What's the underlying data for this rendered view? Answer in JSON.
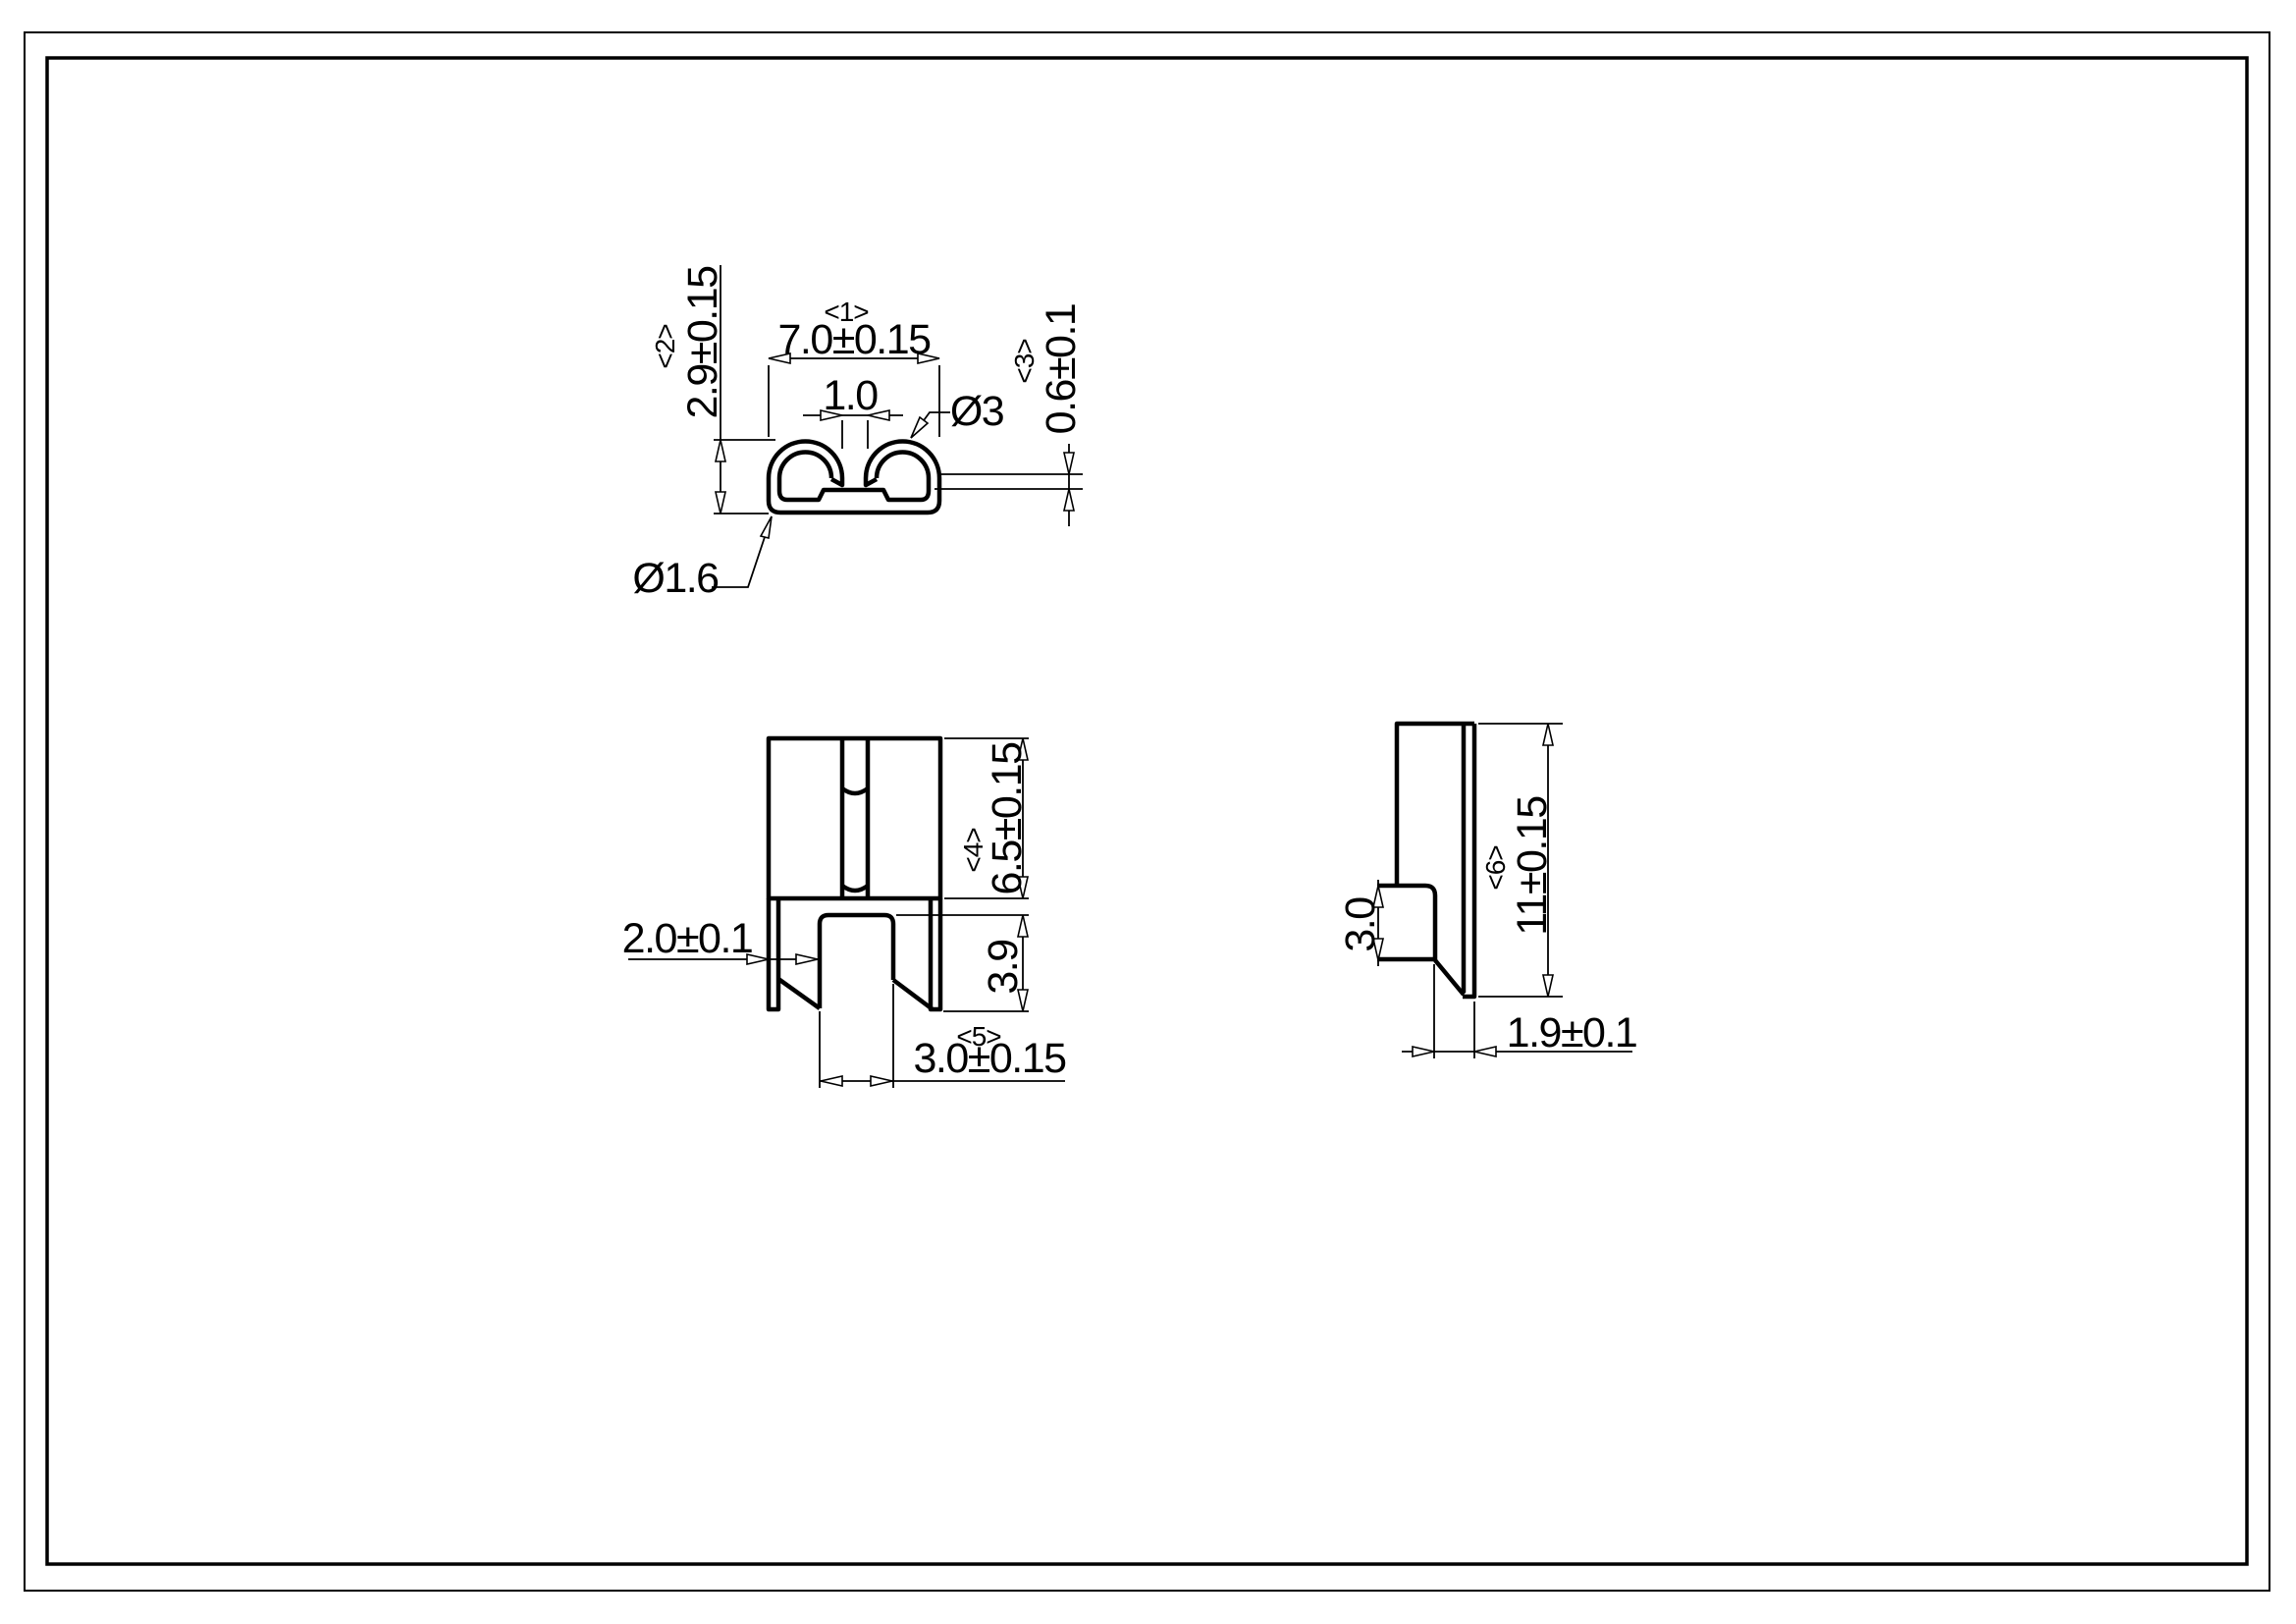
{
  "drawing": {
    "type": "engineering-drawing",
    "colors": {
      "line": "#000000",
      "background": "#ffffff"
    },
    "views": {
      "top": {
        "dim_width": {
          "tag": "<1>",
          "value": "7.0±0.15"
        },
        "dim_height": {
          "tag": "<2>",
          "value": "2.9±0.15"
        },
        "dim_thickness": {
          "tag": "<3>",
          "value": "0.6±0.1"
        },
        "dim_gap": {
          "value": "1.0"
        },
        "dim_hook_diameter": {
          "value": "Ø3"
        },
        "dim_corner_diameter": {
          "value": "Ø1.6"
        }
      },
      "front": {
        "dim_body_height": {
          "tag": "<4>",
          "value": "6.5±0.15"
        },
        "dim_leg_height": {
          "value": "3.9"
        },
        "dim_leg_offset": {
          "value": "2.0±0.1"
        },
        "dim_tab_width": {
          "tag": "<5>",
          "value": "3.0±0.15"
        }
      },
      "side": {
        "dim_height": {
          "tag": "<6>",
          "value": "11±0.15"
        },
        "dim_tab_height": {
          "value": "3.0"
        },
        "dim_foot_width": {
          "value": "1.9±0.1"
        }
      }
    }
  }
}
